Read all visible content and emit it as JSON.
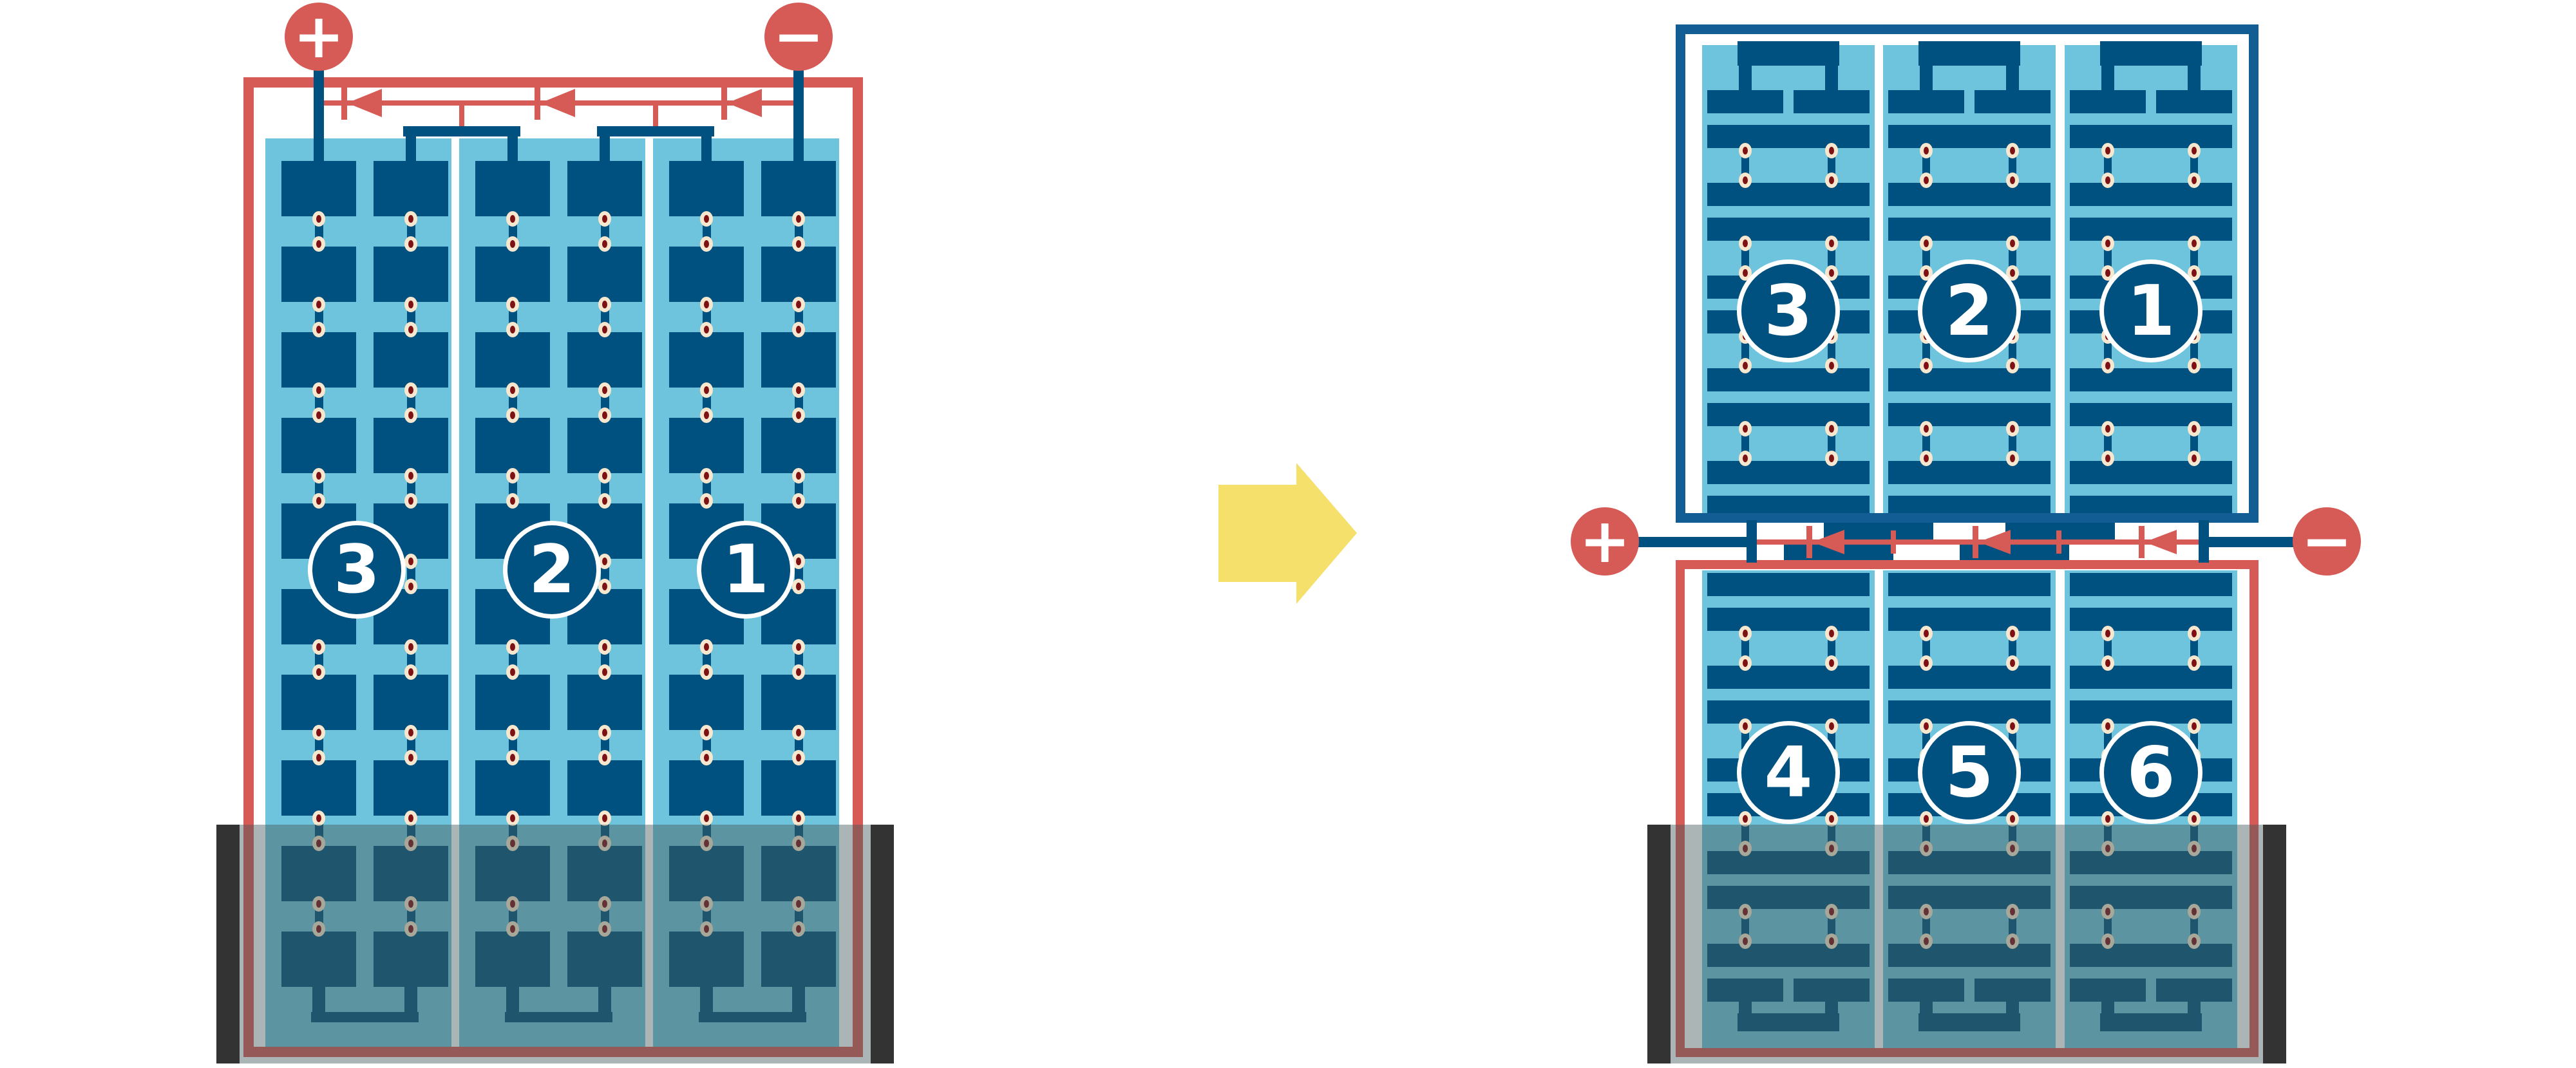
{
  "diagram": {
    "kind": "solar module bypass-diode wiring: full-cell module vs half-cut split module",
    "terminals": {
      "positive": "+",
      "negative": "−"
    },
    "modules": {
      "left": {
        "substrings": [
          "3",
          "2",
          "1"
        ]
      },
      "right_top": {
        "substrings": [
          "3",
          "2",
          "1"
        ]
      },
      "right_bottom": {
        "substrings": [
          "4",
          "5",
          "6"
        ]
      }
    },
    "colors": {
      "red": "#D65A55",
      "frame_blue": "#135D95",
      "cell_blue": "#00517F",
      "glass_blue": "#6EC4DD",
      "dot_cream": "#F7E7CE",
      "dot_red": "#7D1114",
      "arrow_yellow": "#F5E06C",
      "shade_overlay": "rgba(70,90,92,0.45)",
      "shade_bar": "#333333",
      "white": "#FFFFFF"
    },
    "icons": {
      "positive_terminal": "plus-terminal-icon",
      "negative_terminal": "minus-terminal-icon",
      "bypass_diode": "bypass-diode-icon",
      "transform_arrow": "right-arrow-icon"
    }
  }
}
